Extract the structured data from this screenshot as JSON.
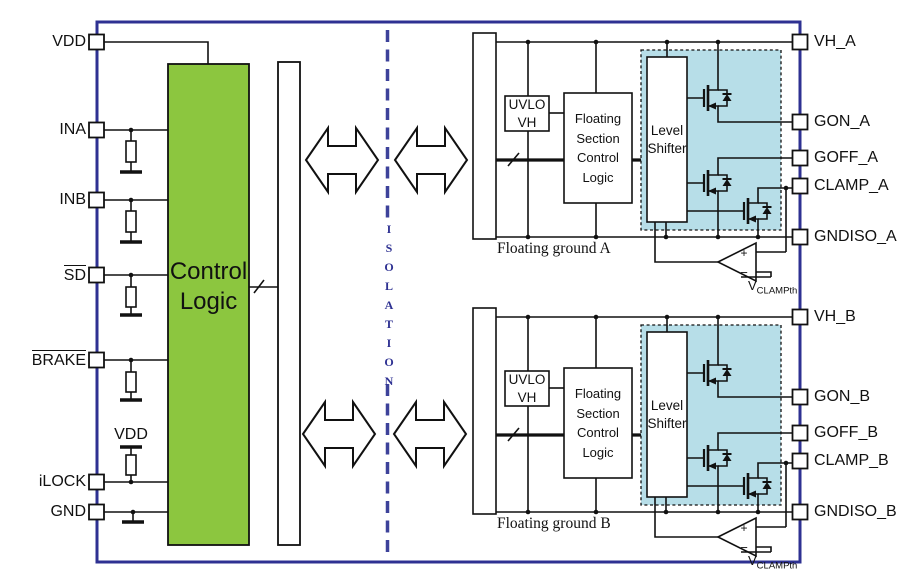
{
  "diagram": {
    "left_pins": [
      {
        "label": "VDD",
        "overline": false
      },
      {
        "label": "INA",
        "overline": false
      },
      {
        "label": "INB",
        "overline": false
      },
      {
        "label": "SD",
        "overline": true
      },
      {
        "label": "BRAKE",
        "overline": true
      },
      {
        "label": "iLOCK",
        "overline": false
      },
      {
        "label": "GND",
        "overline": false
      }
    ],
    "right_pins": [
      {
        "label": "VH_A"
      },
      {
        "label": "GON_A"
      },
      {
        "label": "GOFF_A"
      },
      {
        "label": "CLAMP_A"
      },
      {
        "label": "GNDISO_A"
      },
      {
        "label": "VH_B"
      },
      {
        "label": "GON_B"
      },
      {
        "label": "GOFF_B"
      },
      {
        "label": "CLAMP_B"
      },
      {
        "label": "GNDISO_B"
      }
    ],
    "blocks": {
      "control_logic": "Control\nLogic",
      "uvlo": "UVLO\nVH",
      "floating_section_control_logic": "Floating\nSection\nControl\nLogic",
      "level_shifter": "Level\nShifter"
    },
    "labels": {
      "isolation": "ISOLATION",
      "floating_ground_a": "Floating ground A",
      "floating_ground_b": "Floating ground B",
      "vdd_pullup": "VDD",
      "vclamp_prefix": "V",
      "vclamp_subscript": "CLAMPth",
      "comparator_plus": "+",
      "comparator_minus": "−"
    },
    "colors": {
      "border_blue": "#2E3192",
      "isolation_blue": "#3D429A",
      "control_logic_green": "#8CC63F",
      "floating_driver_blue": "#B7DEE8"
    }
  }
}
